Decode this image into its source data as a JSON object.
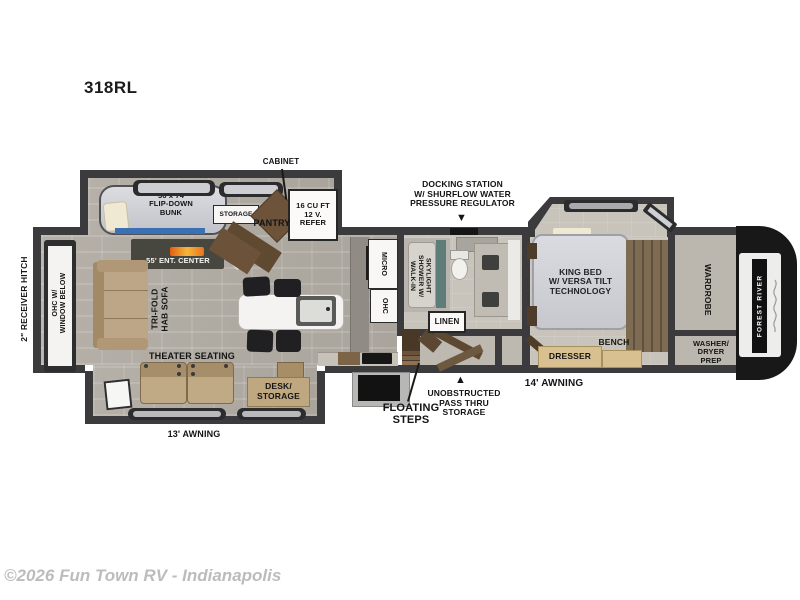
{
  "header": {
    "model": "318RL"
  },
  "footer": {
    "watermark": "©2026 Fun Town RV - Indianapolis"
  },
  "colors": {
    "wall": "#3b3b3d",
    "floor_living": "#b0aba3",
    "floor_bedroom": "#c8c4bb",
    "accent_blue": "#3a71b5",
    "sofa_tan": "#bca583",
    "cabinet_brown": "#6d5339",
    "bed_gray": "#d6d7dc",
    "fireplace_orange": "#e8731c",
    "brand_black": "#161616",
    "watermark_gray": "#bcbcbc"
  },
  "fp": {
    "bunk_room": {
      "cabinet": "CABINET",
      "bunk": "36 x 74\nFLIP-DOWN\nBUNK",
      "storage": "STORAGE",
      "pantry": "PANTRY",
      "refer": "16 CU FT\n12 V.\nREFER"
    },
    "living": {
      "receiver_hitch": "2\" RECEIVER HITCH",
      "ohc_window": "OHC W/\nWINDOW BELOW",
      "ent_center": "55' ENT. CENTER",
      "tri_fold": "TRI-FOLD\nHAB SOFA",
      "theater": "THEATER SEATING",
      "desk": "DESK/\nSTORAGE",
      "awning": "13' AWNING"
    },
    "kitchen": {
      "micro": "MICRO",
      "ohc": "OHC"
    },
    "bath": {
      "docking": "DOCKING STATION\nW/ SHURFLOW WATER\nPRESSURE REGULATOR",
      "shower": "WALK-IN\nSHOWER W/\nSKYLIGHT",
      "linen": "LINEN"
    },
    "mid": {
      "floating_steps": "FLOATING\nSTEPS",
      "pass_thru": "UNOBSTRUCTED\nPASS THRU\nSTORAGE",
      "awning": "14' AWNING"
    },
    "bedroom": {
      "king_bed": "KING BED\nW/ VERSA TILT\nTECHNOLOGY",
      "dresser": "DRESSER",
      "bench": "BENCH"
    },
    "front": {
      "wardrobe": "WARDROBE",
      "washer_dryer": "WASHER/\nDRYER\nPREP",
      "brand": "FOREST RIVER"
    }
  },
  "icons": {
    "arrow_down": "▼",
    "arrow_up": "▲"
  }
}
